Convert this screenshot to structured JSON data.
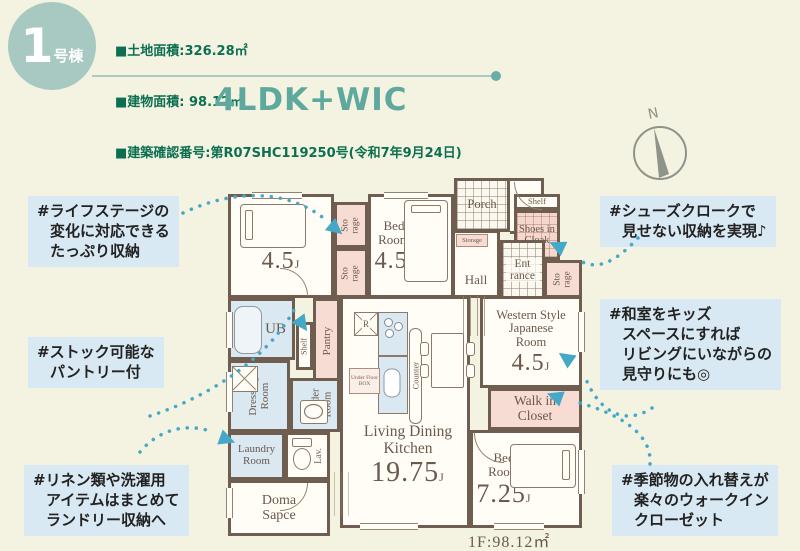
{
  "header": {
    "badge": {
      "number": "1",
      "suffix": "号棟"
    },
    "info_lines": [
      "■土地面積:326.28㎡",
      "■建物面積: 98.12㎡",
      "■建築確認番号:第R07SHC119250号(令和7年9月24日)"
    ],
    "plan_type": "4LDK+WIC"
  },
  "compass": {
    "label": "N"
  },
  "callouts": [
    {
      "id": "storage",
      "lines": [
        "#ライフステージの",
        "変化に対応できる",
        "たっぷり収納"
      ]
    },
    {
      "id": "pantry",
      "lines": [
        "#ストック可能な",
        "パントリー付"
      ]
    },
    {
      "id": "laundry",
      "lines": [
        "#リネン類や洗濯用",
        "アイテムはまとめて",
        "ランドリー収納へ"
      ]
    },
    {
      "id": "shoes",
      "lines": [
        "#シューズクロークで",
        "見せない収納を実現♪"
      ]
    },
    {
      "id": "tatami",
      "lines": [
        "#和室をキッズ",
        "スペースにすれば",
        "リビングにいながらの",
        "見守りにも◎"
      ]
    },
    {
      "id": "wic",
      "lines": [
        "#季節物の入れ替えが",
        "楽々のウォークイン",
        "クローゼット"
      ]
    }
  ],
  "plan": {
    "rooms": {
      "bedroom1": {
        "name": "Bed Room",
        "size": "4.5",
        "unit": "J"
      },
      "bedroom2": {
        "name": "Bed Room",
        "size": "4.5",
        "unit": "J"
      },
      "bedroom3": {
        "name": "Bed Room",
        "size": "7.25",
        "unit": "J"
      },
      "ldk": {
        "name": "Living Dining Kitchen",
        "size": "19.75",
        "unit": "J"
      },
      "japanese": {
        "name": "Western Style Japanese Room",
        "size": "4.5",
        "unit": "J"
      },
      "wic": {
        "name": "Walk in Closet"
      },
      "storage_a": {
        "name": "Sto rage"
      },
      "storage_b": {
        "name": "Sto rage"
      },
      "storage_c": {
        "name": "Sto rage"
      },
      "storage_hall": {
        "name": "Storage"
      },
      "porch": {
        "name": "Porch"
      },
      "hall": {
        "name": "Hall"
      },
      "entrance": {
        "name": "Ent rance"
      },
      "shelf_shoes": {
        "name": "Shelf"
      },
      "shoes": {
        "name": "Shoes in Cloak"
      },
      "ub": {
        "name": "UB"
      },
      "shelf_pantry": {
        "name": "Shelf"
      },
      "pantry": {
        "name": "Pantry"
      },
      "dressing": {
        "name": "Dressing Room"
      },
      "powder": {
        "name": "Powder Room"
      },
      "laundry": {
        "name": "Laundry Room"
      },
      "lav": {
        "name": "Lav."
      },
      "doma": {
        "name": "Doma Sapce"
      },
      "counter": {
        "name": "Counter"
      },
      "fridge": {
        "name": "R"
      },
      "underfloor": {
        "name": "Under Floor BOX"
      }
    },
    "floor_area": "1F:98.12㎡"
  },
  "colors": {
    "background": "#f4f3e1",
    "badge": "#a7c9c2",
    "title_teal": "#5fa89e",
    "info_green": "#0c6f52",
    "callout_bg": "#d9e9f3",
    "wall_brown": "#6f5e50",
    "room_pink": "#f6dcd3",
    "room_blue": "#d9e8f1",
    "arrow_teal": "#45a8c7"
  }
}
